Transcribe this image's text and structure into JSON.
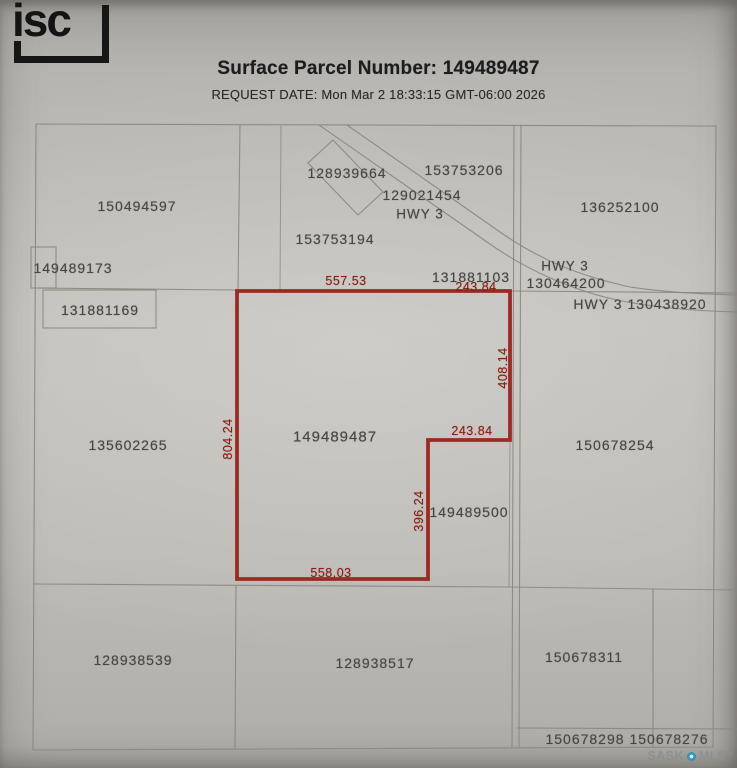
{
  "header": {
    "logo": "isc",
    "title": "Surface Parcel Number: 149489487",
    "request_date": "REQUEST DATE: Mon Mar 2 18:33:15 GMT-06:00 2026"
  },
  "map": {
    "highlighted_parcel": "149489487",
    "parcels": {
      "p150494597": "150494597",
      "p149489173": "149489173",
      "p131881169": "131881169",
      "p128939664": "128939664",
      "p153753206": "153753206",
      "p129021454": "129021454",
      "p153753194": "153753194",
      "p131881103": "131881103",
      "p136252100": "136252100",
      "p130464200": "130464200",
      "p130438920": "130438920",
      "p135602265": "135602265",
      "p149489487": "149489487",
      "p150678254": "150678254",
      "p149489500": "149489500",
      "p128938539": "128938539",
      "p128938517": "128938517",
      "p150678311": "150678311",
      "p150678298": "150678298",
      "p150678276": "150678276"
    },
    "highway_labels": {
      "top": "HWY 3",
      "right_upper": "HWY 3",
      "right_lower": "HWY 3"
    },
    "dimensions": {
      "top": "557.53",
      "top_right": "243.84",
      "right": "408.14",
      "left": "804.24",
      "notch_width": "243.84",
      "notch_height": "396.24",
      "bottom": "558.03"
    }
  },
  "watermark": {
    "sask": "SASK",
    "mls": "MLS",
    "reg": "®"
  },
  "colors": {
    "parcel_highlight_red": "#9b231c",
    "dimension_text_red": "#8c2018",
    "boundary_gray": "#8a867d",
    "paper_gray": "#bdbbb6",
    "mls_dot_blue": "#2d96b6"
  }
}
